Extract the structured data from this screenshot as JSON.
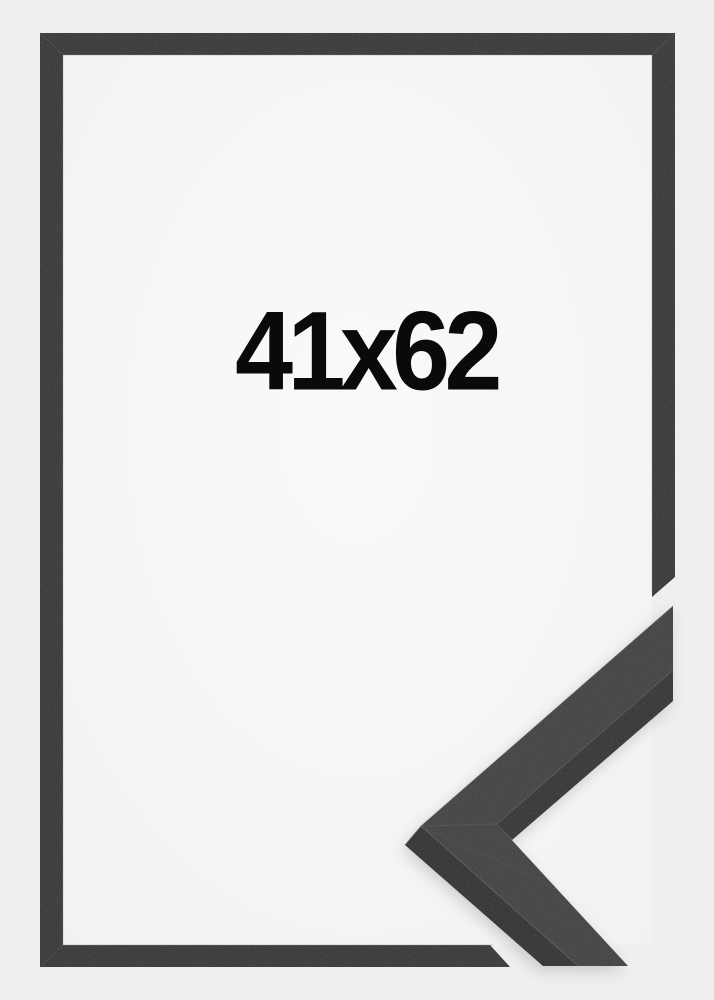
{
  "size_label": "41x62",
  "colors": {
    "page_background": "#efeff0",
    "interior_center": "#fafafa",
    "interior_edge": "#f1f1f2",
    "moulding": "#333335",
    "moulding_inner_highlight": "#8a8a8d",
    "miter_line": "#4d4d50",
    "corner_top_face": "#3c3c3e",
    "corner_side_face": "#29292b",
    "corner_under_edge": "#2d2d2f",
    "seam_highlight": "#5a5a5e",
    "label_text": "#0a0a0a"
  }
}
